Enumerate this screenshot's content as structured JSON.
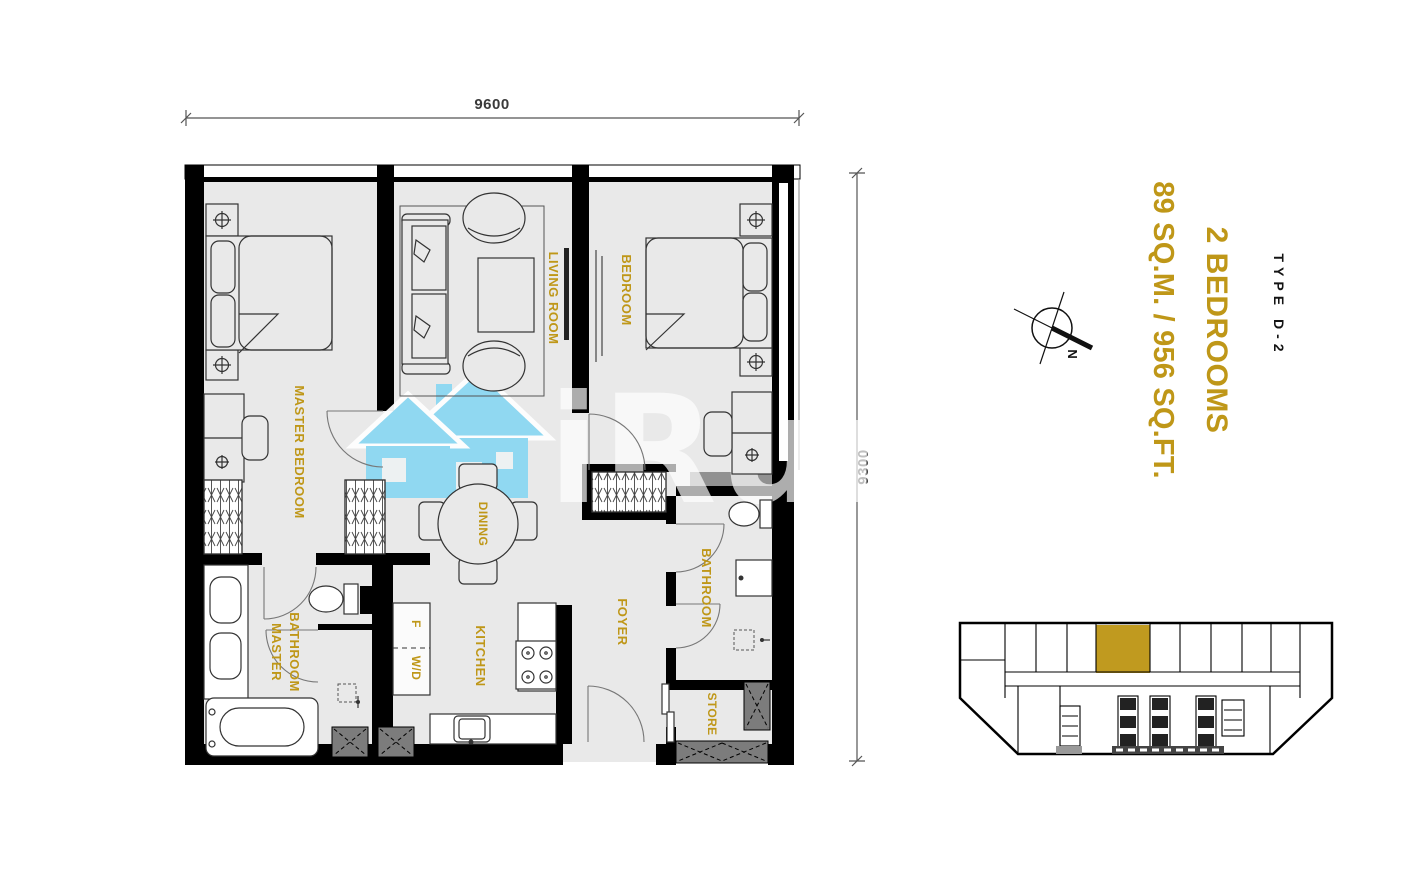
{
  "plan": {
    "dimension_width": "9600",
    "dimension_height": "9300",
    "rooms": {
      "master_bedroom": "MASTER BEDROOM",
      "living_room": "LIVING ROOM",
      "bedroom": "BEDROOM",
      "dining": "DINING",
      "master_bathroom_line1": "MASTER",
      "master_bathroom_line2": "BATHROOM",
      "kitchen": "KITCHEN",
      "foyer": "FOYER",
      "bathroom": "BATHROOM",
      "store": "STORE",
      "fridge": "F",
      "washer_dryer": "W/D"
    }
  },
  "annotation": {
    "type_label": "TYPE D-2",
    "bedrooms_label": "2 BEDROOMS",
    "area_label": "89 SQ.M. / 956 SQ.FT."
  },
  "compass": {
    "north_label": "N"
  },
  "watermark": {
    "text": "iRun"
  },
  "colors": {
    "gold": "#BF9718",
    "keyplan_unit_gold": "#C09A1F",
    "watermark_blue": "#8BD7F2",
    "floor_gray": "#E9E9E9",
    "wall_black": "#000000"
  }
}
